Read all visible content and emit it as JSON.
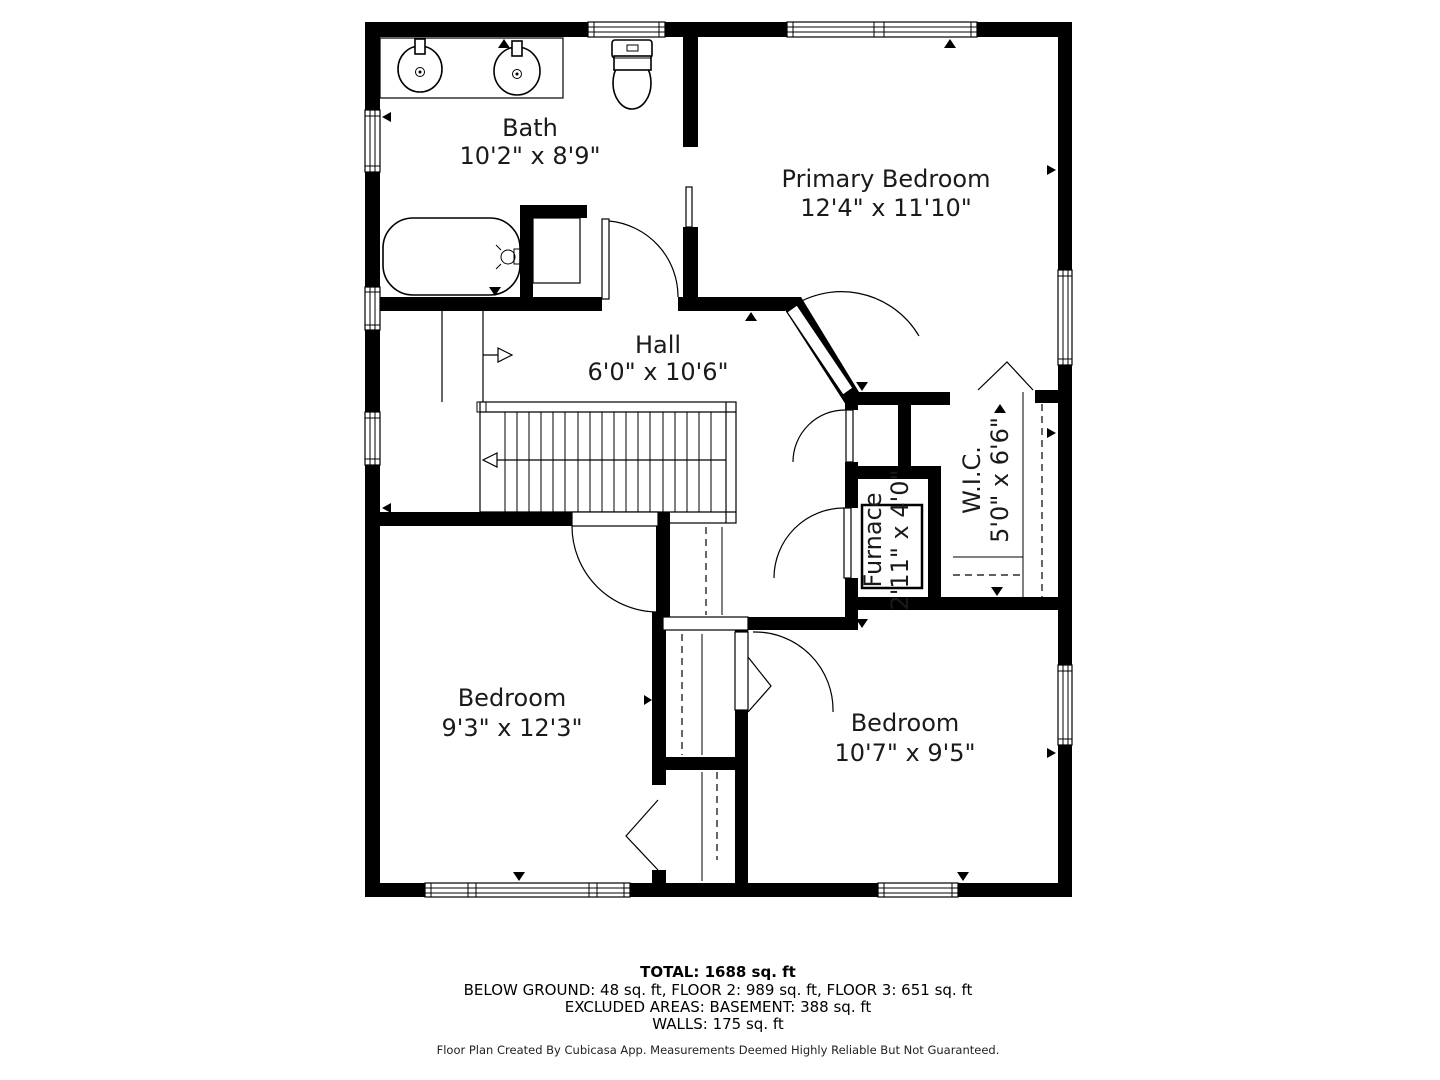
{
  "floor_plan": {
    "rooms": [
      {
        "name": "Bath",
        "dims": "10'2\" x 8'9\""
      },
      {
        "name": "Primary Bedroom",
        "dims": "12'4\" x 11'10\""
      },
      {
        "name": "Hall",
        "dims": "6'0\" x 10'6\""
      },
      {
        "name": "Furnace",
        "dims": "2'11\" x 4'0\""
      },
      {
        "name": "W.I.C.",
        "dims": "5'0\" x 6'6\""
      },
      {
        "name": "Bedroom",
        "dims": "9'3\" x 12'3\""
      },
      {
        "name": "Bedroom",
        "dims": "10'7\" x 9'5\""
      }
    ],
    "summary": {
      "total": "TOTAL: 1688 sq. ft",
      "floors": "BELOW GROUND: 48 sq. ft, FLOOR 2: 989 sq. ft, FLOOR 3: 651 sq. ft",
      "excluded": "EXCLUDED AREAS: BASEMENT: 388 sq. ft",
      "walls": "WALLS: 175 sq. ft"
    },
    "footer": "Floor Plan Created By Cubicasa App. Measurements Deemed Highly Reliable But Not Guaranteed."
  }
}
